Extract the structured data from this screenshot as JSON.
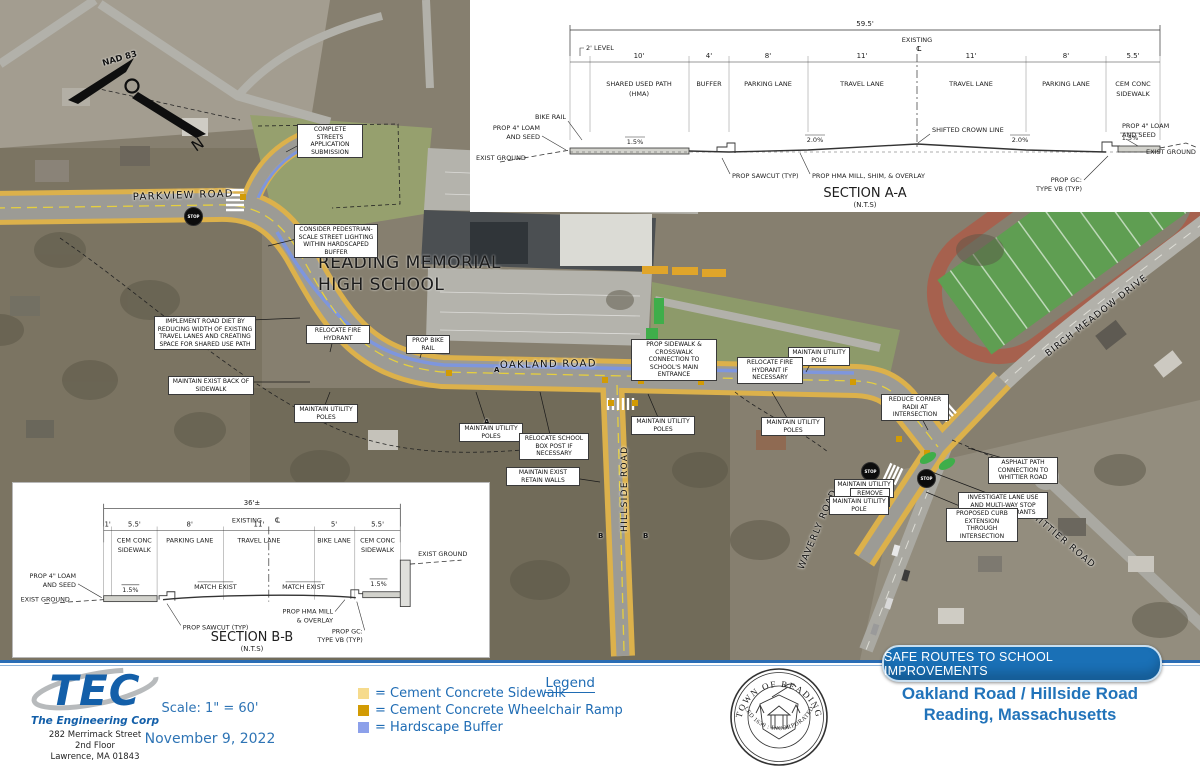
{
  "colors": {
    "sidewalk": "#DCB14B",
    "ramp": "#D29B04",
    "buffer": "#7E96DD",
    "blue_text": "#1F6CB4",
    "banner_blue": "#1A70B6"
  },
  "plan": {
    "school_label": [
      "READING MEMORIAL",
      "HIGH SCHOOL"
    ],
    "north_label": "NAD 83",
    "north_n": "N",
    "stop_label": "STOP",
    "street_labels": [
      {
        "t": "PARKVIEW ROAD",
        "x": 133,
        "y": 206,
        "r": -2,
        "s": 10
      },
      {
        "t": "OAKLAND ROAD",
        "x": 500,
        "y": 374,
        "r": -1,
        "s": 10
      },
      {
        "t": "HILLSIDE ROAD",
        "x": 630,
        "y": 535,
        "r": -90,
        "s": 9
      },
      {
        "t": "WAVERLY ROAD",
        "x": 806,
        "y": 574,
        "r": -67,
        "s": 9
      },
      {
        "t": "WHITTIER ROAD",
        "x": 1022,
        "y": 516,
        "r": 40,
        "s": 9
      },
      {
        "t": "BIRCH MEADOW DRIVE",
        "x": 1050,
        "y": 362,
        "r": -38,
        "s": 9
      }
    ],
    "stop_signs": [
      {
        "x": 184,
        "y": 207
      },
      {
        "x": 861,
        "y": 462
      },
      {
        "x": 917,
        "y": 469
      }
    ],
    "section_markers": [
      {
        "t": "A",
        "x": 494,
        "y": 366
      },
      {
        "t": "A",
        "x": 484,
        "y": 418
      },
      {
        "t": "B",
        "x": 598,
        "y": 532
      },
      {
        "t": "B",
        "x": 643,
        "y": 532
      }
    ],
    "callouts": [
      {
        "t": "COMPLETE STREETS APPLICATION SUBMISSION",
        "x": 297,
        "y": 124,
        "w": 60,
        "lx": 286,
        "ly": 152
      },
      {
        "t": "CONSIDER PEDESTRIAN-SCALE STREET LIGHTING WITHIN HARDSCAPED BUFFER",
        "x": 294,
        "y": 224,
        "w": 78,
        "lx": 268,
        "ly": 246
      },
      {
        "t": "IMPLEMENT ROAD DIET BY REDUCING WIDTH OF EXISTING TRAVEL LANES AND CREATING SPACE FOR SHARED USE PATH",
        "x": 154,
        "y": 316,
        "w": 96,
        "lx": 300,
        "ly": 318
      },
      {
        "t": "RELOCATE FIRE HYDRANT",
        "x": 306,
        "y": 325,
        "w": 58,
        "lx": 330,
        "ly": 352
      },
      {
        "t": "PROP BIKE RAIL",
        "x": 406,
        "y": 335,
        "w": 38,
        "lx": 420,
        "ly": 358
      },
      {
        "t": "MAINTAIN EXIST BACK OF SIDEWALK",
        "x": 168,
        "y": 376,
        "w": 80,
        "lx": 310,
        "ly": 382
      },
      {
        "t": "MAINTAIN UTILITY POLES",
        "x": 294,
        "y": 404,
        "w": 58,
        "lx": 330,
        "ly": 392
      },
      {
        "t": "MAINTAIN UTILITY POLES",
        "x": 459,
        "y": 423,
        "w": 58,
        "lx": 476,
        "ly": 392
      },
      {
        "t": "PROP SIDEWALK & CROSSWALK CONNECTION TO SCHOOL'S MAIN ENTRANCE",
        "x": 631,
        "y": 339,
        "w": 80,
        "lx": 655,
        "ly": 362
      },
      {
        "t": "RELOCATE SCHOOL BOX POST IF NECESSARY",
        "x": 519,
        "y": 433,
        "w": 64,
        "lx": 540,
        "ly": 392
      },
      {
        "t": "MAINTAIN UTILITY POLES",
        "x": 631,
        "y": 416,
        "w": 58,
        "lx": 648,
        "ly": 394
      },
      {
        "t": "MAINTAIN UTILITY POLES",
        "x": 761,
        "y": 417,
        "w": 58,
        "lx": 772,
        "ly": 392
      },
      {
        "t": "MAINTAIN UTILITY POLE",
        "x": 788,
        "y": 347,
        "w": 56,
        "lx": 806,
        "ly": 372
      },
      {
        "t": "RELOCATE FIRE HYDRANT IF NECESSARY",
        "x": 737,
        "y": 357,
        "w": 60,
        "lx": 788,
        "ly": 374
      },
      {
        "t": "REDUCE CORNER RADII AT INTERSECTION",
        "x": 881,
        "y": 394,
        "w": 62,
        "lx": 928,
        "ly": 430
      },
      {
        "t": "MAINTAIN EXIST RETAIN WALLS",
        "x": 506,
        "y": 467,
        "w": 68,
        "lx": 600,
        "ly": 482
      },
      {
        "t": "MAINTAIN UTILITY POLE",
        "x": 834,
        "y": 479,
        "w": 54,
        "lx": 878,
        "ly": 466
      },
      {
        "t": "REMOVE POST",
        "x": 850,
        "y": 488,
        "w": 34,
        "lx": 886,
        "ly": 480
      },
      {
        "t": "MAINTAIN UTILITY POLE",
        "x": 829,
        "y": 496,
        "w": 54,
        "lx": 876,
        "ly": 492
      },
      {
        "t": "ASPHALT PATH CONNECTION TO WHITTIER ROAD",
        "x": 988,
        "y": 457,
        "w": 64,
        "lx": 968,
        "ly": 448
      },
      {
        "t": "INVESTIGATE LANE USE AND MULTI-WAY STOP CONTROL WARRANTS",
        "x": 958,
        "y": 492,
        "w": 84,
        "lx": 932,
        "ly": 472
      },
      {
        "t": "PROPOSED CURB EXTENSION THROUGH INTERSECTION",
        "x": 946,
        "y": 508,
        "w": 66,
        "lx": 926,
        "ly": 492
      }
    ]
  },
  "section_a": {
    "title": "SECTION A-A",
    "nts": "(N.T.S)",
    "overall": "59.5'",
    "existing": "EXISTING",
    "cl": "CL",
    "level_label": "2' LEVEL",
    "dims": [
      "10'",
      "4'",
      "8'",
      "11'",
      "11'",
      "8'",
      "5.5'"
    ],
    "lanes": [
      [
        "SHARED USED PATH",
        "(HMA)"
      ],
      [
        "BUFFER",
        ""
      ],
      [
        "PARKING LANE",
        ""
      ],
      [
        "TRAVEL LANE",
        ""
      ],
      [
        "TRAVEL LANE",
        ""
      ],
      [
        "PARKING LANE",
        ""
      ],
      [
        "CEM CONC",
        "SIDEWALK"
      ]
    ],
    "slopes": [
      "1.5%",
      "2.0%",
      "2.0%",
      "1.5%"
    ],
    "labels": {
      "bike_rail": "BIKE RAIL",
      "loam1": "PROP 4\" LOAM",
      "loam2": "AND SEED",
      "exist_ground_l": "EXIST GROUND",
      "sawcut": "PROP SAWCUT (TYP)",
      "mill": "PROP HMA MILL, SHIM, & OVERLAY",
      "crown": "SHIFTED CROWN LINE",
      "gc1": "PROP GC:",
      "gc2": "TYPE VB (TYP)",
      "loam_r1": "PROP 4\" LOAM",
      "loam_r2": "AND SEED",
      "exist_ground_r": "EXIST GROUND"
    }
  },
  "section_b": {
    "title": "SECTION B-B",
    "nts": "(N.T.S)",
    "overall": "36'±",
    "existing": "EXISTING",
    "cl": "CL",
    "dims": [
      "1'",
      "5.5'",
      "8'",
      "11'",
      "5'",
      "5.5'"
    ],
    "lanes": [
      [
        "",
        ""
      ],
      [
        "CEM CONC",
        "SIDEWALK"
      ],
      [
        "PARKING LANE",
        ""
      ],
      [
        "TRAVEL LANE",
        ""
      ],
      [
        "BIKE LANE",
        ""
      ],
      [
        "CEM CONC",
        "SIDEWALK"
      ]
    ],
    "slopes": [
      "1.5%",
      "MATCH EXIST",
      "MATCH EXIST",
      "1.5%"
    ],
    "labels": {
      "loam1": "PROP 4\" LOAM",
      "loam2": "AND SEED",
      "exist_ground_l": "EXIST GROUND",
      "sawcut": "PROP SAWCUT (TYP)",
      "mill1": "PROP HMA MILL",
      "mill2": "& OVERLAY",
      "gc1": "PROP GC:",
      "gc2": "TYPE VB (TYP)",
      "exist_ground_r": "EXIST GROUND"
    }
  },
  "footer": {
    "tec": {
      "name": "TEC",
      "tagline": "The Engineering Corp",
      "address": [
        "282 Merrimack Street",
        "2nd Floor",
        "Lawrence, MA 01843"
      ]
    },
    "scale": "Scale: 1\" = 60'",
    "date": "November 9, 2022",
    "legend": {
      "title": "Legend",
      "items": [
        {
          "swatch": "#F6DB8D",
          "label": "= Cement Concrete Sidewalk"
        },
        {
          "swatch": "#D29B04",
          "label": "= Cement Concrete Wheelchair Ramp"
        },
        {
          "swatch": "#8CA0EA",
          "label": "= Hardscape Buffer"
        }
      ]
    },
    "seal": {
      "arc_top": "TOWN OF READING",
      "arc_bottom": "SETTLED 1639 : INCORPORATED 1644"
    },
    "banner": "SAFE ROUTES TO SCHOOL IMPROVEMENTS",
    "project_title": [
      "Oakland Road / Hillside Road",
      "Reading, Massachusetts"
    ]
  }
}
